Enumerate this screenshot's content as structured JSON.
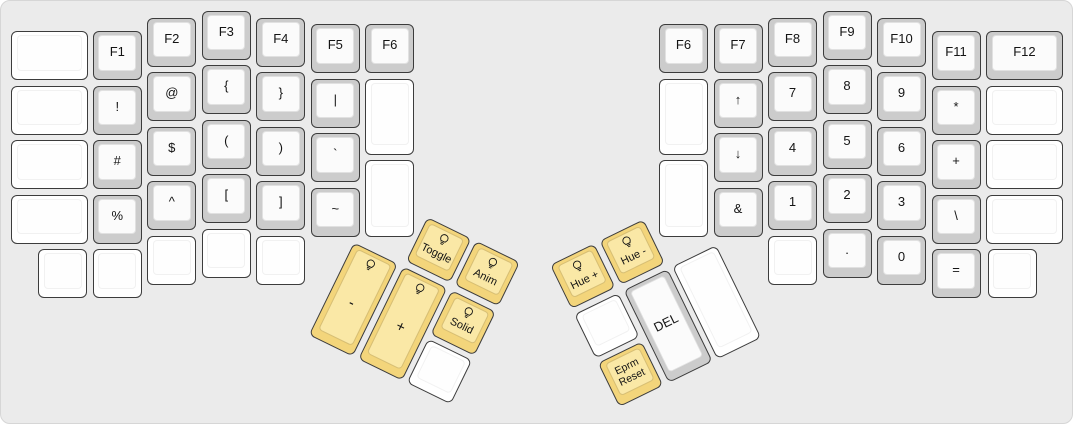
{
  "panel": {
    "width": 1073,
    "height": 424,
    "corner_radius": 10
  },
  "colors": {
    "background": "#ebebeb",
    "panel_border": "#d6d6d6",
    "key_border": "#3c3c3c",
    "key_gray": "#cccccc",
    "key_gray_top": "#fbfbfb",
    "key_white": "#ffffff",
    "key_white_top": "#fefefe",
    "key_yellow": "#f3d57b",
    "key_yellow_top": "#fae8a6",
    "legend": "#141414"
  },
  "keys": [
    {
      "name": "key-blank",
      "label": "",
      "color": "white",
      "x": 10,
      "y": 30,
      "w": 76.8,
      "h": 49
    },
    {
      "name": "key-blank",
      "label": "",
      "color": "white",
      "x": 10,
      "y": 84.5,
      "w": 76.8,
      "h": 49
    },
    {
      "name": "key-blank",
      "label": "",
      "color": "white",
      "x": 10,
      "y": 139,
      "w": 76.8,
      "h": 49
    },
    {
      "name": "key-blank",
      "label": "",
      "color": "white",
      "x": 10,
      "y": 193.5,
      "w": 76.8,
      "h": 49
    },
    {
      "name": "key-f1",
      "label": "F1",
      "color": "gray",
      "x": 91.8,
      "y": 30
    },
    {
      "name": "key-exclamation",
      "label": "!",
      "color": "gray",
      "x": 91.8,
      "y": 84.5
    },
    {
      "name": "key-hash",
      "label": "#",
      "color": "gray",
      "x": 91.8,
      "y": 139
    },
    {
      "name": "key-percent",
      "label": "%",
      "color": "gray",
      "x": 91.8,
      "y": 193.5
    },
    {
      "name": "key-f2",
      "label": "F2",
      "color": "gray",
      "x": 146.3,
      "y": 16.5
    },
    {
      "name": "key-at",
      "label": "@",
      "color": "gray",
      "x": 146.3,
      "y": 71
    },
    {
      "name": "key-dollar",
      "label": "$",
      "color": "gray",
      "x": 146.3,
      "y": 125.5
    },
    {
      "name": "key-caret",
      "label": "^",
      "color": "gray",
      "x": 146.3,
      "y": 180
    },
    {
      "name": "key-f3",
      "label": "F3",
      "color": "gray",
      "x": 200.8,
      "y": 9.5
    },
    {
      "name": "key-open-brace",
      "label": "{",
      "color": "gray",
      "x": 200.8,
      "y": 64
    },
    {
      "name": "key-open-paren",
      "label": "(",
      "color": "gray",
      "x": 200.8,
      "y": 118.5
    },
    {
      "name": "key-open-bracket",
      "label": "[",
      "color": "gray",
      "x": 200.8,
      "y": 173
    },
    {
      "name": "key-f4",
      "label": "F4",
      "color": "gray",
      "x": 255.3,
      "y": 16.5
    },
    {
      "name": "key-close-brace",
      "label": "}",
      "color": "gray",
      "x": 255.3,
      "y": 71
    },
    {
      "name": "key-close-paren",
      "label": ")",
      "color": "gray",
      "x": 255.3,
      "y": 125.5
    },
    {
      "name": "key-close-bracket",
      "label": "]",
      "color": "gray",
      "x": 255.3,
      "y": 180
    },
    {
      "name": "key-f5",
      "label": "F5",
      "color": "gray",
      "x": 309.8,
      "y": 23
    },
    {
      "name": "key-pipe",
      "label": "|",
      "color": "gray",
      "x": 309.8,
      "y": 77.5
    },
    {
      "name": "key-backtick",
      "label": "`",
      "color": "gray",
      "x": 309.8,
      "y": 132
    },
    {
      "name": "key-tilde",
      "label": "~",
      "color": "gray",
      "x": 309.8,
      "y": 186.5
    },
    {
      "name": "key-f6-left",
      "label": "F6",
      "color": "gray",
      "x": 364.3,
      "y": 23
    },
    {
      "name": "key-blank",
      "label": "",
      "color": "white",
      "x": 364.3,
      "y": 77.5,
      "h": 76.3
    },
    {
      "name": "key-blank",
      "label": "",
      "color": "white",
      "x": 364.3,
      "y": 159.3,
      "h": 76.3
    },
    {
      "name": "key-blank",
      "label": "",
      "color": "white",
      "x": 37.3,
      "y": 248
    },
    {
      "name": "key-blank",
      "label": "",
      "color": "white",
      "x": 91.8,
      "y": 248
    },
    {
      "name": "key-blank",
      "label": "",
      "color": "white",
      "x": 146.3,
      "y": 234.5
    },
    {
      "name": "key-blank",
      "label": "",
      "color": "white",
      "x": 200.8,
      "y": 227.5
    },
    {
      "name": "key-blank",
      "label": "",
      "color": "white",
      "x": 255.3,
      "y": 234.5
    },
    {
      "name": "key-f6-right",
      "label": "F6",
      "color": "gray",
      "x": 658,
      "y": 23
    },
    {
      "name": "key-blank",
      "label": "",
      "color": "white",
      "x": 658,
      "y": 77.5,
      "h": 76.3
    },
    {
      "name": "key-blank",
      "label": "",
      "color": "white",
      "x": 658,
      "y": 159.3,
      "h": 76.3
    },
    {
      "name": "key-f7",
      "label": "F7",
      "color": "gray",
      "x": 712.5,
      "y": 23
    },
    {
      "name": "key-arrow-up",
      "label": "↑",
      "color": "gray",
      "x": 712.5,
      "y": 77.5
    },
    {
      "name": "key-arrow-down",
      "label": "↓",
      "color": "gray",
      "x": 712.5,
      "y": 132
    },
    {
      "name": "key-ampersand",
      "label": "&",
      "color": "gray",
      "x": 712.5,
      "y": 186.5
    },
    {
      "name": "key-f8",
      "label": "F8",
      "color": "gray",
      "x": 767,
      "y": 16.5
    },
    {
      "name": "key-7",
      "label": "7",
      "color": "gray",
      "x": 767,
      "y": 71
    },
    {
      "name": "key-4",
      "label": "4",
      "color": "gray",
      "x": 767,
      "y": 125.5
    },
    {
      "name": "key-1",
      "label": "1",
      "color": "gray",
      "x": 767,
      "y": 180
    },
    {
      "name": "key-f9",
      "label": "F9",
      "color": "gray",
      "x": 821.5,
      "y": 9.5
    },
    {
      "name": "key-8",
      "label": "8",
      "color": "gray",
      "x": 821.5,
      "y": 64
    },
    {
      "name": "key-5",
      "label": "5",
      "color": "gray",
      "x": 821.5,
      "y": 118.5
    },
    {
      "name": "key-2",
      "label": "2",
      "color": "gray",
      "x": 821.5,
      "y": 173
    },
    {
      "name": "key-f10",
      "label": "F10",
      "color": "gray",
      "x": 876,
      "y": 16.5
    },
    {
      "name": "key-9",
      "label": "9",
      "color": "gray",
      "x": 876,
      "y": 71
    },
    {
      "name": "key-6",
      "label": "6",
      "color": "gray",
      "x": 876,
      "y": 125.5
    },
    {
      "name": "key-3",
      "label": "3",
      "color": "gray",
      "x": 876,
      "y": 180
    },
    {
      "name": "key-f11",
      "label": "F11",
      "color": "gray",
      "x": 930.5,
      "y": 30
    },
    {
      "name": "key-asterisk",
      "label": "*",
      "color": "gray",
      "x": 930.5,
      "y": 84.5
    },
    {
      "name": "key-plus",
      "label": "+",
      "color": "gray",
      "x": 930.5,
      "y": 139
    },
    {
      "name": "key-backslash",
      "label": "\\",
      "color": "gray",
      "x": 930.5,
      "y": 193.5
    },
    {
      "name": "key-f12",
      "label": "F12",
      "color": "gray",
      "x": 985,
      "y": 30,
      "w": 76.8
    },
    {
      "name": "key-blank",
      "label": "",
      "color": "white",
      "x": 985,
      "y": 84.5,
      "w": 76.8
    },
    {
      "name": "key-blank",
      "label": "",
      "color": "white",
      "x": 985,
      "y": 139,
      "w": 76.8
    },
    {
      "name": "key-blank",
      "label": "",
      "color": "white",
      "x": 985,
      "y": 193.5,
      "w": 76.8
    },
    {
      "name": "key-blank",
      "label": "",
      "color": "white",
      "x": 767,
      "y": 234.5
    },
    {
      "name": "key-period",
      "label": ".",
      "color": "gray",
      "x": 821.5,
      "y": 227.5
    },
    {
      "name": "key-0",
      "label": "0",
      "color": "gray",
      "x": 876,
      "y": 234.5
    },
    {
      "name": "key-equals",
      "label": "=",
      "color": "gray",
      "x": 930.5,
      "y": 248
    },
    {
      "name": "key-blank",
      "label": "",
      "color": "white",
      "x": 986.8,
      "y": 248
    }
  ],
  "thumb_clusters": [
    {
      "name": "left-thumb-cluster",
      "x": 377,
      "y": 192,
      "angle": 26,
      "keys": [
        {
          "name": "key-led-toggle",
          "label": "Toggle",
          "color": "yellow",
          "icon": "lightbulb",
          "fs": 11,
          "x": 54.5,
          "y": 0
        },
        {
          "name": "key-led-anim",
          "label": "Anim",
          "color": "yellow",
          "icon": "lightbulb",
          "fs": 11,
          "x": 109,
          "y": 0
        },
        {
          "name": "key-brightness-minus",
          "label": "-",
          "color": "yellow",
          "icon": "lightbulb",
          "fs": 15,
          "x": 0,
          "y": 54.5,
          "h": 103.5
        },
        {
          "name": "key-brightness-plus",
          "label": "+",
          "color": "yellow",
          "icon": "lightbulb",
          "fs": 15,
          "x": 54.5,
          "y": 54.5,
          "h": 103.5
        },
        {
          "name": "key-led-solid",
          "label": "Solid",
          "color": "yellow",
          "icon": "lightbulb",
          "fs": 11,
          "x": 109,
          "y": 54.5
        },
        {
          "name": "key-blank",
          "label": "",
          "color": "white",
          "x": 109,
          "y": 109
        }
      ]
    },
    {
      "name": "right-thumb-cluster",
      "x": 549,
      "y": 264,
      "angle": -26,
      "keys": [
        {
          "name": "key-hue-plus",
          "label": "Hue +",
          "color": "yellow",
          "icon": "lightbulb",
          "fs": 11,
          "x": 0,
          "y": 0
        },
        {
          "name": "key-hue-minus",
          "label": "Hue -",
          "color": "yellow",
          "icon": "lightbulb",
          "fs": 11,
          "x": 54.5,
          "y": 0
        },
        {
          "name": "key-blank",
          "label": "",
          "color": "white",
          "x": 0,
          "y": 54.5
        },
        {
          "name": "key-del",
          "label": "DEL",
          "color": "gray",
          "fs": 13,
          "x": 54.5,
          "y": 54.5,
          "h": 103.5
        },
        {
          "name": "key-blank",
          "label": "",
          "color": "white",
          "x": 109,
          "y": 54.5,
          "h": 103.5
        },
        {
          "name": "key-eprm-reset",
          "lines": [
            "Eprm",
            "Reset"
          ],
          "color": "yellow",
          "fs": 10.5,
          "x": 0,
          "y": 109
        }
      ]
    }
  ]
}
